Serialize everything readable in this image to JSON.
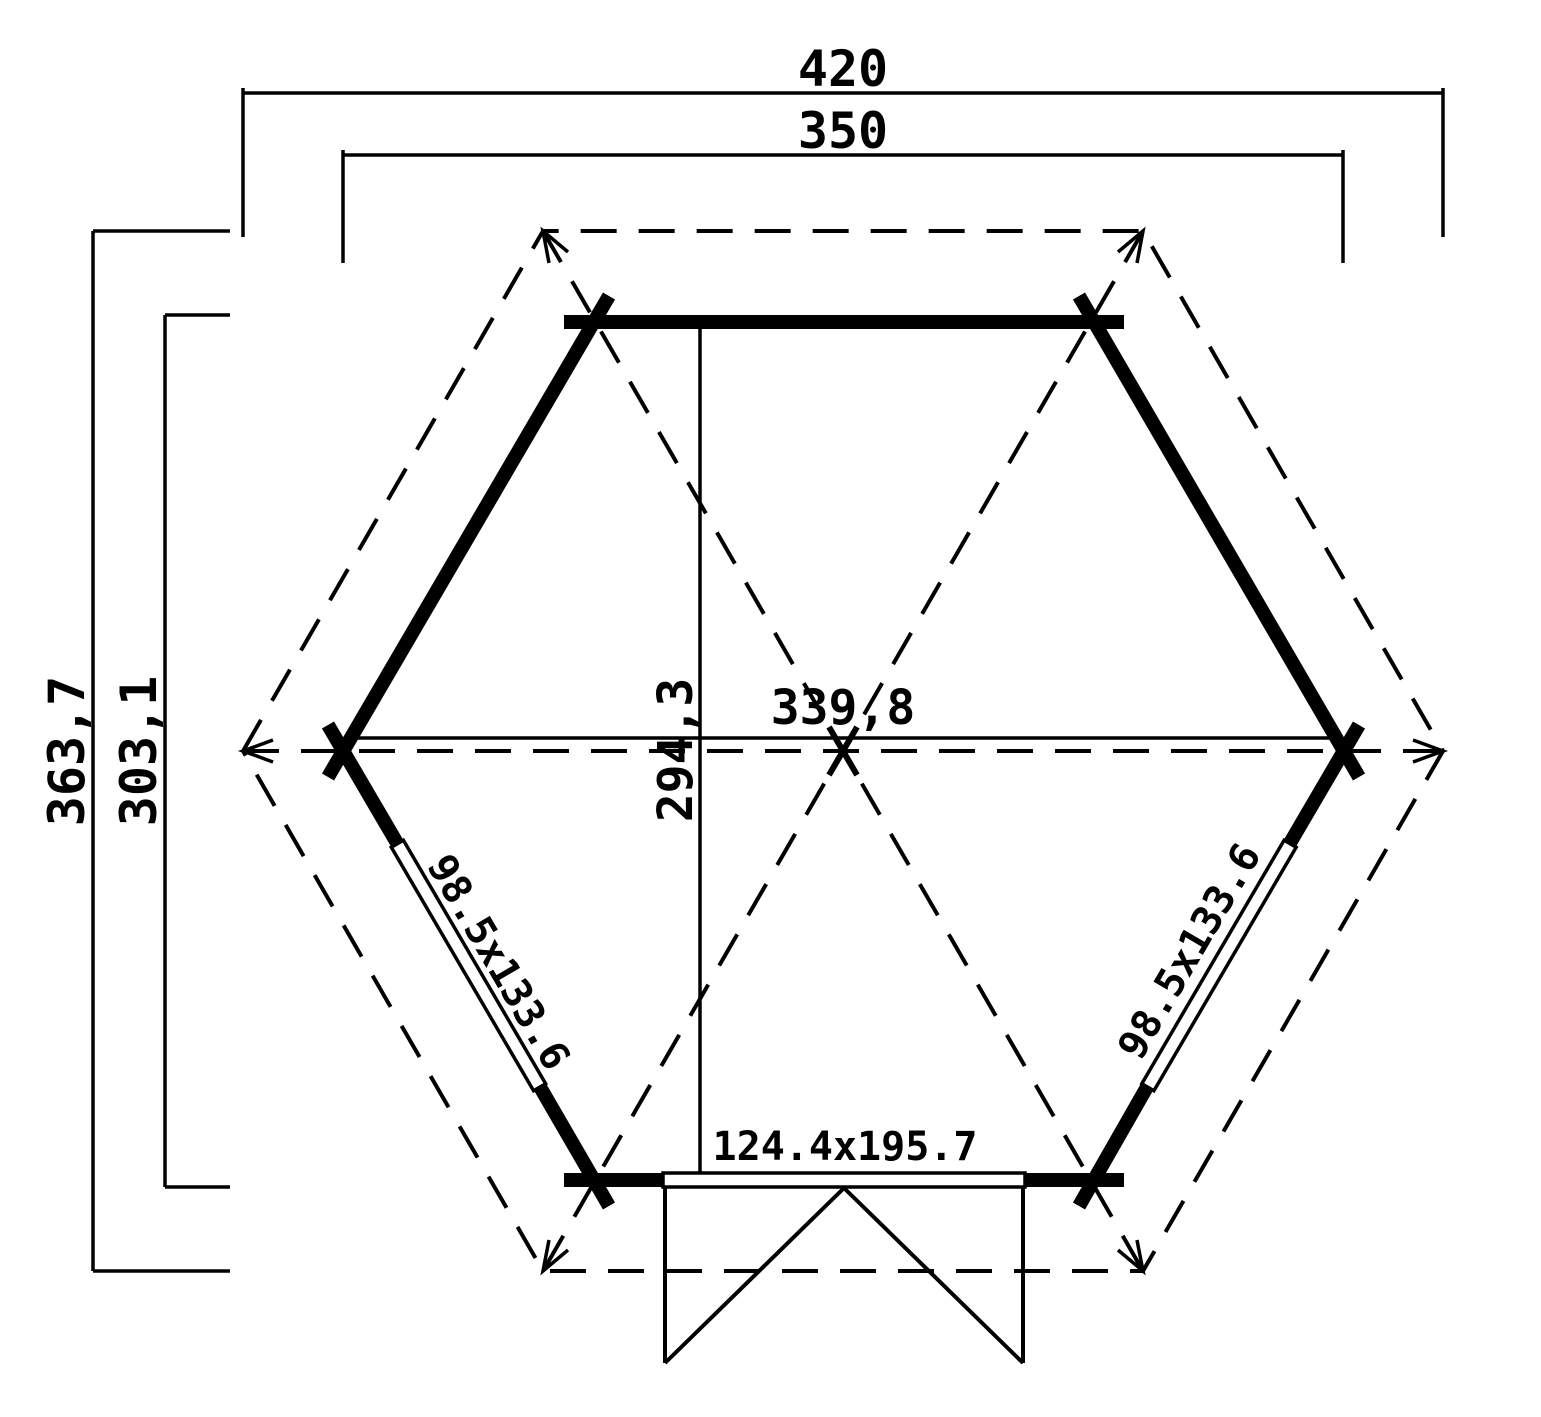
{
  "drawing": {
    "kind": "hexagonal gazebo floor plan"
  },
  "dimensions": {
    "roof_width": "420",
    "wall_width": "350",
    "roof_depth": "363,7",
    "wall_depth": "303,1",
    "inner_depth": "294,3",
    "inner_width": "339,8"
  },
  "openings": {
    "window_left": "98.5x133.6",
    "window_right": "98.5x133.6",
    "door": "124.4x195.7"
  },
  "colors": {
    "ink": "#000000",
    "paper": "#ffffff"
  }
}
